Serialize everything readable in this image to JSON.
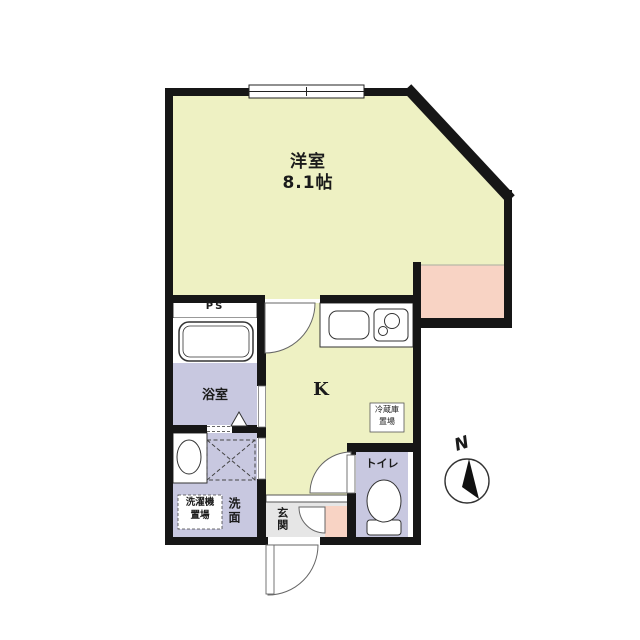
{
  "floorplan": {
    "title": "apartment-floorplan",
    "rooms": {
      "main_room": {
        "label": "洋室",
        "size": "8.1帖"
      },
      "kitchen": {
        "label": "K"
      },
      "bathroom": {
        "label": "浴室"
      },
      "toilet": {
        "label": "トイレ"
      },
      "entrance": {
        "label": "玄関"
      },
      "washroom": {
        "label": "洗面"
      },
      "washer_space": {
        "line1": "洗濯機",
        "line2": "置場"
      },
      "fridge_space": {
        "line1": "冷蔵庫",
        "line2": "置場"
      },
      "pipe_space": {
        "label": "PS"
      }
    },
    "compass": {
      "label": "N"
    },
    "colors": {
      "room_yellow": "#eef1c3",
      "balcony_pink": "#f8d3c4",
      "wet_area_lavender": "#c8c8e0",
      "entrance_gray": "#e6e6e6",
      "wall_black": "#161616",
      "fixture_white": "#ffffff"
    }
  }
}
